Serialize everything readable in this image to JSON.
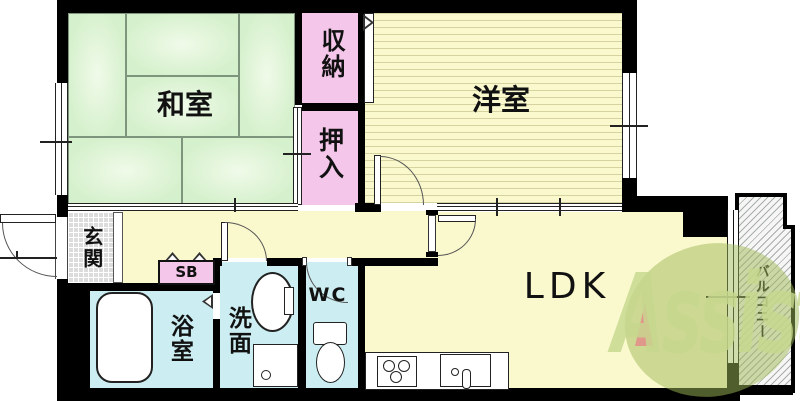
{
  "title": "apartment-floor-plan",
  "labels": {
    "washitsu": "和室",
    "youshitsu": "洋室",
    "shuunou": "収納",
    "oshiire": "押入",
    "genkan": "玄関",
    "yokushitsu": "浴室",
    "senmen": "洗面",
    "wc": "WC",
    "ldk": "LDK",
    "sb": "SB",
    "balcony": "バルコニー"
  },
  "logo": {
    "text": "Assist"
  },
  "colors": {
    "wall": "#000000",
    "tatami_green": "#d5f0cc",
    "wood_yellow": "#faf8cd",
    "closet_pink": "#f4c6ea",
    "wet_blue": "#cceef2",
    "genkan_gray": "#dcdcdc",
    "logo_green": "#9fba58",
    "logo_text_green": "#c6d88e",
    "logo_accent_salmon": "#e2938b"
  }
}
